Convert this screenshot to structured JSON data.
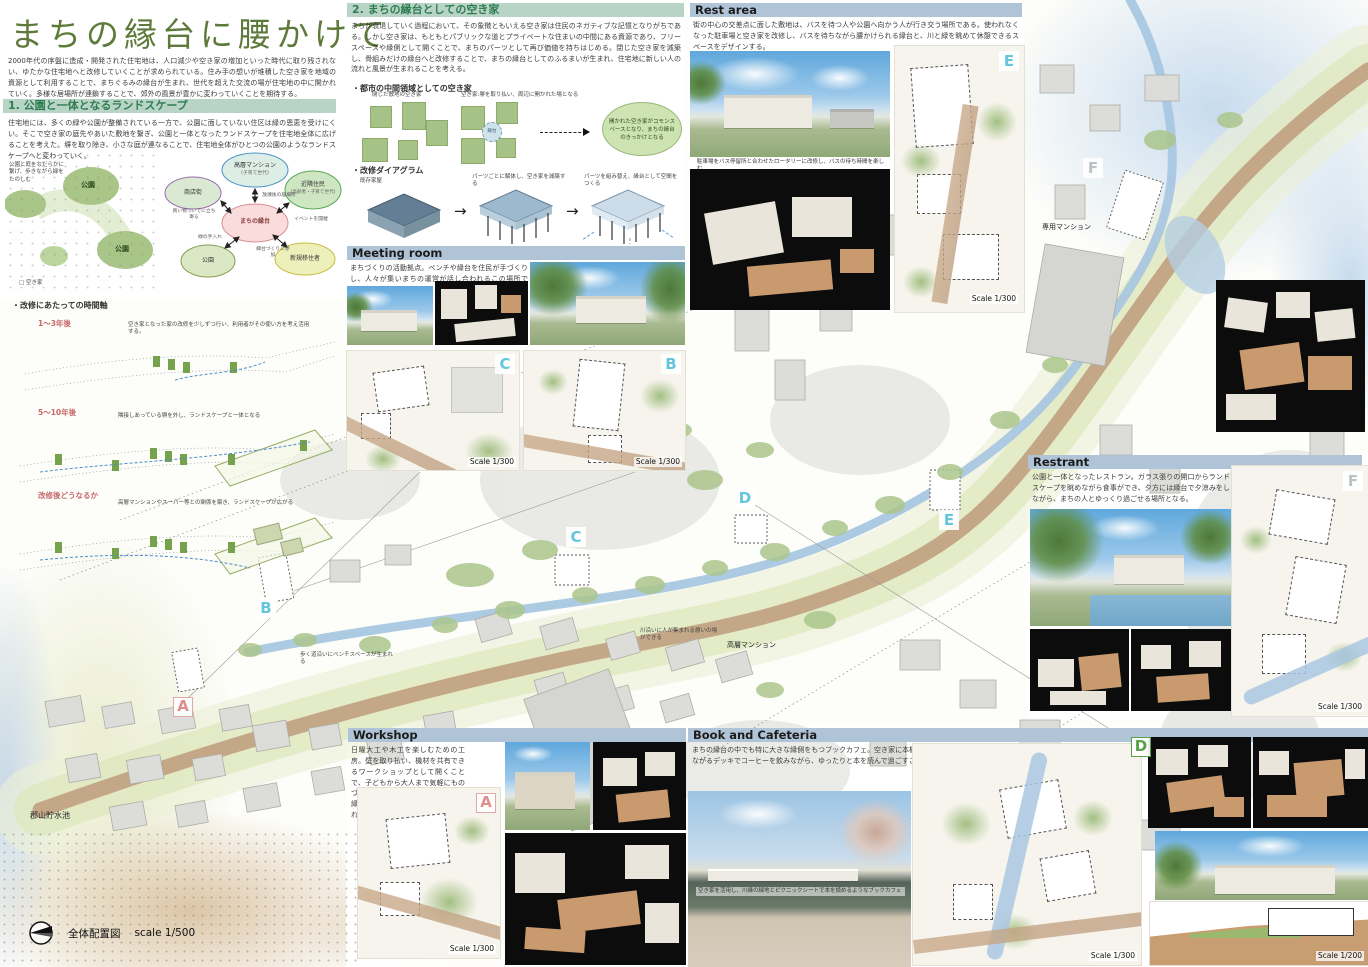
{
  "title_block": {
    "title": "まちの縁台に腰かけて",
    "intro": "2000年代の序盤に造成・開発された住宅地は、人口減少や空き家の増加といった時代に取り残されない、ゆたかな住宅地へと改修していくことが求められている。住み手の想いが堆積した空き家を地域の資源として利用することで、まちぐるみの縁台が生まれ、世代を超えた交流の場が住宅地の中に開かれていく。多様な居場所が連鎖することで、郊外の風景が豊かに変わっていくことを期待する。"
  },
  "section1": {
    "heading": "1. 公園と一体となるランドスケープ",
    "body": "住宅地には、多くの緑や公園が整備されている一方で、公園に面していない住区は緑の恩恵を受けにくい。そこで空き家の庭先やあいた敷地を繋ぎ、公園と一体となったランドスケープを住宅地全体に広げることを考えた。塀を取り除き、小さな庭が連なることで、住宅地全体がひとつの公園のようなランドスケープへと変わっていく。",
    "park_diagram": {
      "caption": "公園と庭をなだらかに繋げ、歩きながら緑をたのしむ",
      "park1": "公園",
      "park2": "公園",
      "legend": "□ 空き家"
    },
    "bubble": {
      "top": "高層マンション",
      "top_sub": "(子育て世代)",
      "left": "商店街",
      "right": "近隣住民",
      "right_sub": "(高齢者・子育て世代)",
      "center": "まちの縁台",
      "bottom_left": "公園",
      "bottom_right": "新規移住者",
      "edges": [
        "買い物ついでに立ち寄る",
        "放課後の居場所",
        "イベントを開催",
        "緑の手入れ",
        "縁台づくりに参加"
      ]
    },
    "timeline": {
      "heading": "・改修にあたっての時間軸",
      "phases": [
        {
          "label": "1〜3年後",
          "note": "空き家となった家の改修を少しずつ行い、利用者がその使い方を考え活用する。"
        },
        {
          "label": "5〜10年後",
          "note": "隣接しあっている塀を外し、ランドスケープと一体となる"
        },
        {
          "label": "改修後どうなるか",
          "note": "高層マンションやスーパー等との関係を築き、ランドスケープが広がる"
        }
      ]
    }
  },
  "section2": {
    "heading": "2. まちの縁台としての空き家",
    "body": "まちが衰退していく過程において、その象徴ともいえる空き家は住民のネガティブな記憶となりがちである。しかし空き家は、もともとパブリックな道とプライベートな住まいの中間にある資源であり、フリースペースや縁側として開くことで、まちのパーツとして再び価値を持ちはじめる。閉じた空き家を減築し、骨組みだけの縁台へと改修することで、まちの縁台としてのふるまいが生まれ、住宅地に新しい人の流れと風景が生まれることを考える。",
    "vacant_diagram": {
      "heading": "・都市の中間領域としての空き家",
      "label1": "閉じた敷地の空き家",
      "label2": "空き家:塀を取り払い、周辺に開かれた場となる",
      "core": "縁台",
      "result": "開かれた空き家がコモンスペースとなり、まちの縁台のきっかけとなる"
    },
    "renovation_diagram": {
      "heading": "・改修ダイアグラム",
      "label1": "既存家屋",
      "label2": "パーツごとに解体し、空き家を減築する",
      "label3": "パーツを組み替え、縁台として空間をつくる"
    }
  },
  "panels": {
    "meeting": {
      "title": "Meeting room",
      "body": "まちづくりの活動拠点。ベンチや縁台を住民が手づくりし、人々が集いまちの運営が話し合われるこの場所では、公園のような風景と、ふらっと立ち寄れる気軽さを大切にした。"
    },
    "rest": {
      "title": "Rest area",
      "body": "街の中心の交差点に面した敷地は、バスを待つ人や公園へ向かう人が行き交う場所である。使われなくなった駐車場と空き家を改修し、バスを待ちながら腰かけられる縁台と、川と緑を眺めて休憩できるスペースをデザインする。",
      "caption": "駐車場をバス停留所と合わせたロータリーに改修し、バスの待ち時間を楽しむ"
    },
    "restrant": {
      "title": "Restrant",
      "body": "公園と一体となったレストラン。ガラス張りの開口からランドスケープを眺めながら食事ができ、夕方には縁台で夕涼みをしながら、まちの人とゆっくり過ごせる場所となる。",
      "caption": "公園を彩るランドスケープとガラス張りのレストラン"
    },
    "workshop": {
      "title": "Workshop",
      "body": "日曜大工や木工を楽しむための工房。壁を取り払い、機材を共有できるワークショップとして開くことで、子どもから大人まで気軽にものづくりに関われる。ここで作られた縁台やベンチが、まちの各所に置かれていく。"
    },
    "book": {
      "title": "Book and Cafeteria",
      "body": "まちの縁台の中でも特に大きな縁側をもつブックカフェ。空き家に本棚を挿入し、川縁の緑地とつながるデッキでコーヒーを飲みながら、ゆったりと本を読んで過ごすことができる。",
      "caption": "空き家を活用し、川縁の緑地とピクニックシートで本を読めるようなブックカフェ"
    }
  },
  "map": {
    "letters": {
      "A": "A",
      "B": "B",
      "C": "C",
      "D": "D",
      "E": "E",
      "F": "F"
    },
    "labels": {
      "reservoir": "郡山貯水池",
      "tower_mansion": "高層マンション",
      "mansion": "専用マンション",
      "river_note": "川沿いに人が集まれる憩いの場ができる",
      "bench_note": "歩く道沿いにベンチスペースが生まれる"
    },
    "legend": {
      "name": "全体配置図",
      "scale": "scale 1/500"
    },
    "scales": {
      "s300": "Scale 1/300",
      "s200": "Scale 1/200"
    }
  }
}
